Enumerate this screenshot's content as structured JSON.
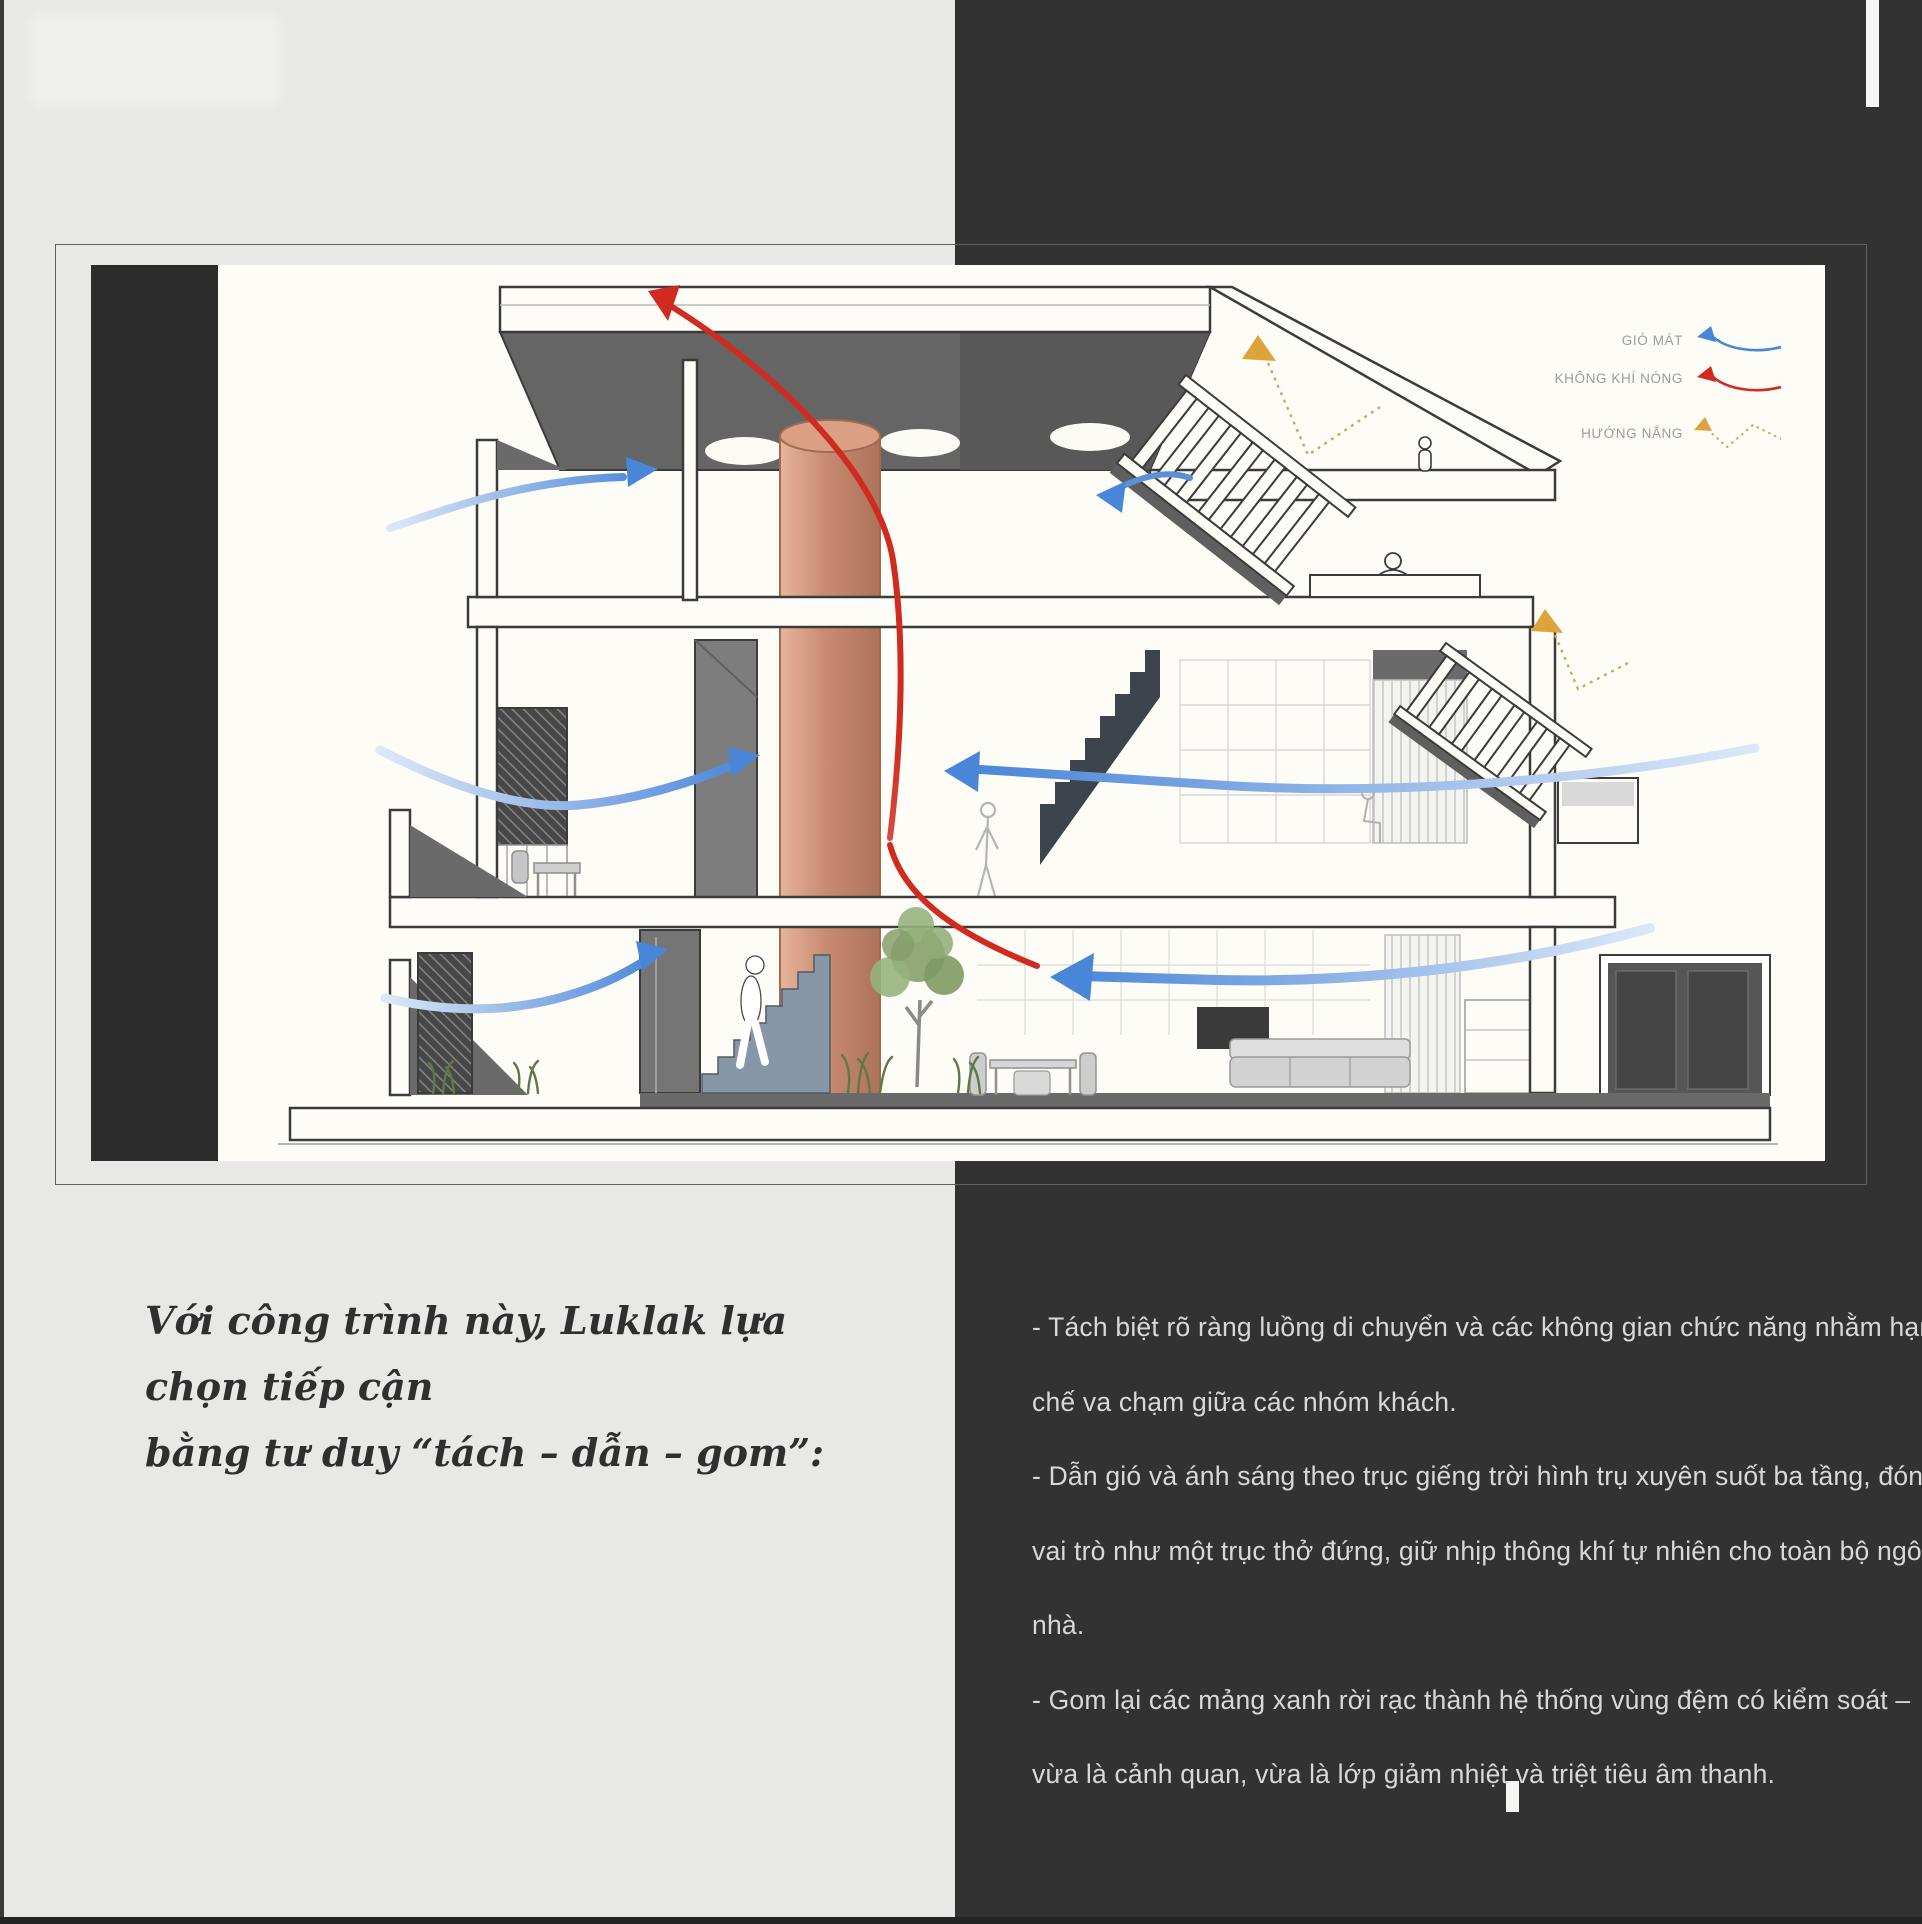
{
  "quote": {
    "lines": [
      "Với công trình này, Luklak lựa chọn tiếp cận",
      "bằng tư duy “tách – dẫn – gom”:"
    ]
  },
  "bullets": {
    "lines": [
      "- Tách biệt rõ ràng luồng di chuyển và các không gian chức năng nhằm hạn",
      "chế va chạm giữa các nhóm khách.",
      "- Dẫn gió và ánh sáng theo trục giếng trời hình trụ xuyên suốt ba tầng, đóng",
      "vai trò như một trục thở đứng, giữ nhịp thông khí tự nhiên cho toàn bộ ngôi",
      "nhà.",
      "- Gom lại các mảng xanh rời rạc thành hệ thống vùng đệm có kiểm soát –",
      "vừa là cảnh quan, vừa là lớp giảm nhiệt và triệt tiêu âm thanh."
    ]
  },
  "legend": {
    "items": [
      {
        "label": "GIÓ MÁT",
        "meaning": "cool wind",
        "color": "#4a86d8"
      },
      {
        "label": "KHÔNG KHÍ NÓNG",
        "meaning": "hot air",
        "color": "#cf2b20"
      },
      {
        "label": "HƯỚNG NẮNG",
        "meaning": "sun direction",
        "color": "#e0a33c"
      }
    ]
  },
  "colors": {
    "panel_light": "#e8e8e7",
    "panel_dark": "#323232",
    "canvas_white": "#fdfcf6",
    "terracotta_shaft": "#c98b72",
    "cool_wind_blue": "#4a86d8",
    "hot_air_red": "#cf2b20",
    "sun_yellow": "#e0a33c"
  }
}
